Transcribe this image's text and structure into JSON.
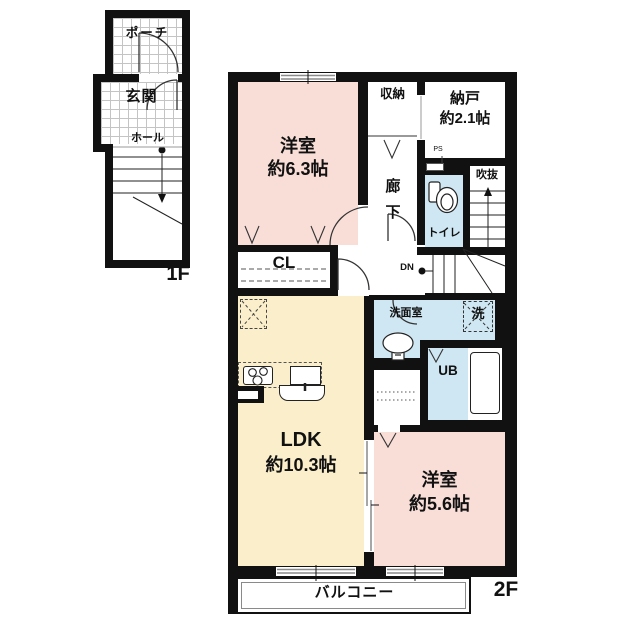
{
  "title": "apartment-floor-plan",
  "floors": [
    {
      "id": "1F",
      "label": "1F"
    },
    {
      "id": "2F",
      "label": "2F"
    }
  ],
  "labels": {
    "porch": "ポーチ",
    "entrance": "玄関",
    "hall": "ホール",
    "f1": "1F",
    "bedroom1_name": "洋室",
    "bedroom1_size": "約6.3帖",
    "shuno": "収納",
    "nando_name": "納戸",
    "nando_size": "約2.1帖",
    "ps": "PS",
    "corridor_char1": "廊",
    "corridor_char2": "下",
    "toilet": "トイレ",
    "void": "吹抜",
    "dn": "DN",
    "cl": "CL",
    "washroom": "洗面室",
    "washer": "洗",
    "ub": "UB",
    "ldk_name": "LDK",
    "ldk_size": "約10.3帖",
    "bedroom2_name": "洋室",
    "bedroom2_size": "約5.6帖",
    "balcony": "バルコニー",
    "f2": "2F"
  },
  "colors": {
    "wall": "#111111",
    "room_pink": "#f9ded8",
    "room_cream": "#faeecb",
    "room_blue": "#cfe7f2"
  }
}
